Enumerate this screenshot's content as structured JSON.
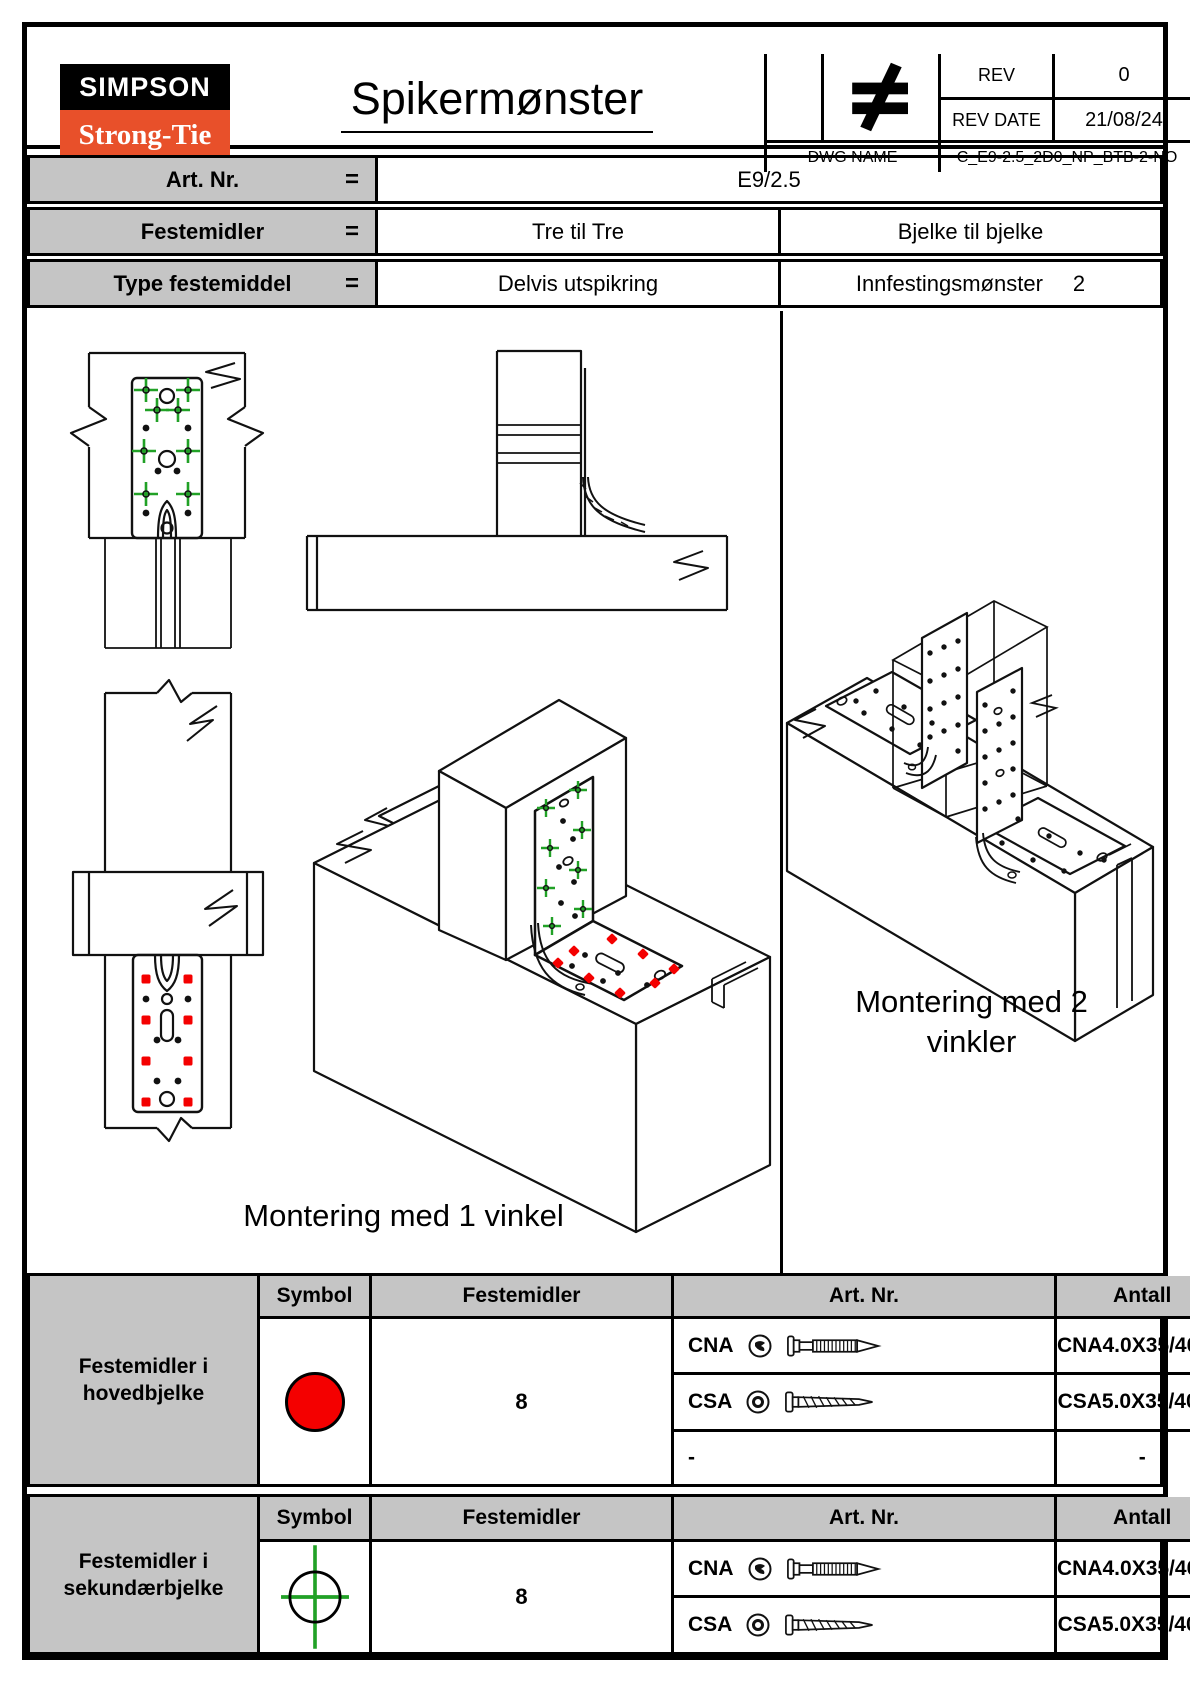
{
  "header": {
    "logo_line1": "SIMPSON",
    "logo_line2": "Strong-Tie",
    "logo_reg_mark": "®",
    "title": "Spikermønster",
    "neq_symbol": "≠",
    "rev_label": "REV",
    "rev_value": "0",
    "rev_date_label": "REV DATE",
    "rev_date_value": "21/08/24",
    "dwg_label": "DWG NAME",
    "dwg_value": "C_E9-2.5_2D0_NP_BTB-2-NO"
  },
  "info": {
    "eq": "=",
    "rows": [
      {
        "label": "Art. Nr.",
        "value": "E9/2.5"
      },
      {
        "label": "Festemidler",
        "left": "Tre til Tre",
        "right": "Bjelke til bjelke"
      },
      {
        "label": "Type festemiddel",
        "left": "Delvis utspikring",
        "right_label": "Innfestingsmønster",
        "right_value": "2"
      }
    ]
  },
  "drawings": {
    "caption_left": "Montering med 1 vinkel",
    "caption_right_line1": "Montering med 2",
    "caption_right_line2": "vinkler",
    "marker_main_beam": "red-dot",
    "marker_secondary_beam": "green-cross"
  },
  "fastener_tables": [
    {
      "group_label_line1": "Festemidler i",
      "group_label_line2": "hovedbjelke",
      "symbol_icon": "red-filled-circle",
      "headers": {
        "symbol": "Symbol",
        "festemidler": "Festemidler",
        "artnr": "Art. Nr.",
        "antall": "Antall"
      },
      "rows": [
        {
          "code": "CNA",
          "head_icon": "cna-nail-head-icon",
          "fastener_icon": "nail",
          "artnr": "CNA4.0X35/40/50"
        },
        {
          "code": "CSA",
          "head_icon": "csa-screw-head-icon",
          "fastener_icon": "screw",
          "artnr": "CSA5.0X35/40/50"
        },
        {
          "code": "-",
          "artnr": "-"
        }
      ],
      "antall_value": "8"
    },
    {
      "group_label_line1": "Festemidler i",
      "group_label_line2": "sekundærbjelke",
      "symbol_icon": "green-crosshair-circle",
      "headers": {
        "symbol": "Symbol",
        "festemidler": "Festemidler",
        "artnr": "Art. Nr.",
        "antall": "Antall"
      },
      "rows": [
        {
          "code": "CNA",
          "head_icon": "cna-nail-head-icon",
          "fastener_icon": "nail",
          "artnr": "CNA4.0X35/40/50"
        },
        {
          "code": "CSA",
          "head_icon": "csa-screw-head-icon",
          "fastener_icon": "screw",
          "artnr": "CSA5.0X35/40/50"
        }
      ],
      "antall_value": "8"
    }
  ],
  "colors": {
    "marker_red": "#f40000",
    "marker_green": "#21a126",
    "logo_orange": "#e8502a",
    "header_gray": "#c5c5c5"
  }
}
